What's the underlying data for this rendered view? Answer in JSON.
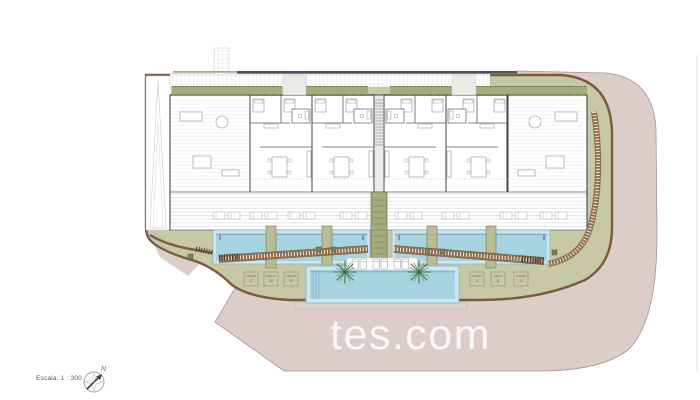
{
  "plan": {
    "scale_label": "Escala: 1 : 300",
    "north_label": "N",
    "watermark": "tes.com",
    "parking_left": [
      {
        "name": "CHALET",
        "num": "07"
      },
      {
        "name": "CHALET",
        "num": "08"
      },
      {
        "name": "CHALET",
        "num": "09"
      }
    ],
    "parking_right": [
      {
        "name": "CHALET",
        "num": "10"
      },
      {
        "name": "CHALET",
        "num": "11"
      },
      {
        "name": "CHALET",
        "num": "12"
      }
    ]
  },
  "colors": {
    "road-pink": "#ddcdc9",
    "road-border": "#a8948a",
    "garden-olive": "#c6c8a6",
    "hedge-green": "#a3ac7d",
    "hedge-dark": "#5f6a42",
    "planter-green": "#b9bd96",
    "path-brown": "#7c5a3e",
    "path-base": "#8a6a4c",
    "path-tie": "#e8dcc8",
    "pool-water": "#a8d4e2",
    "pool-rim": "#8fb8c4",
    "pool-rim-fill": "#cde7ee",
    "wall-dark": "#3f454b",
    "line-light": "#c9ced2",
    "furniture-gray": "#8e959b",
    "top-line-slate": "#4a5663",
    "palm-green": "#41704a",
    "palm-light": "#6d9b5f",
    "text-gray": "#5a5a5a",
    "watermark-white": "rgba(255,255,255,0.85)"
  }
}
